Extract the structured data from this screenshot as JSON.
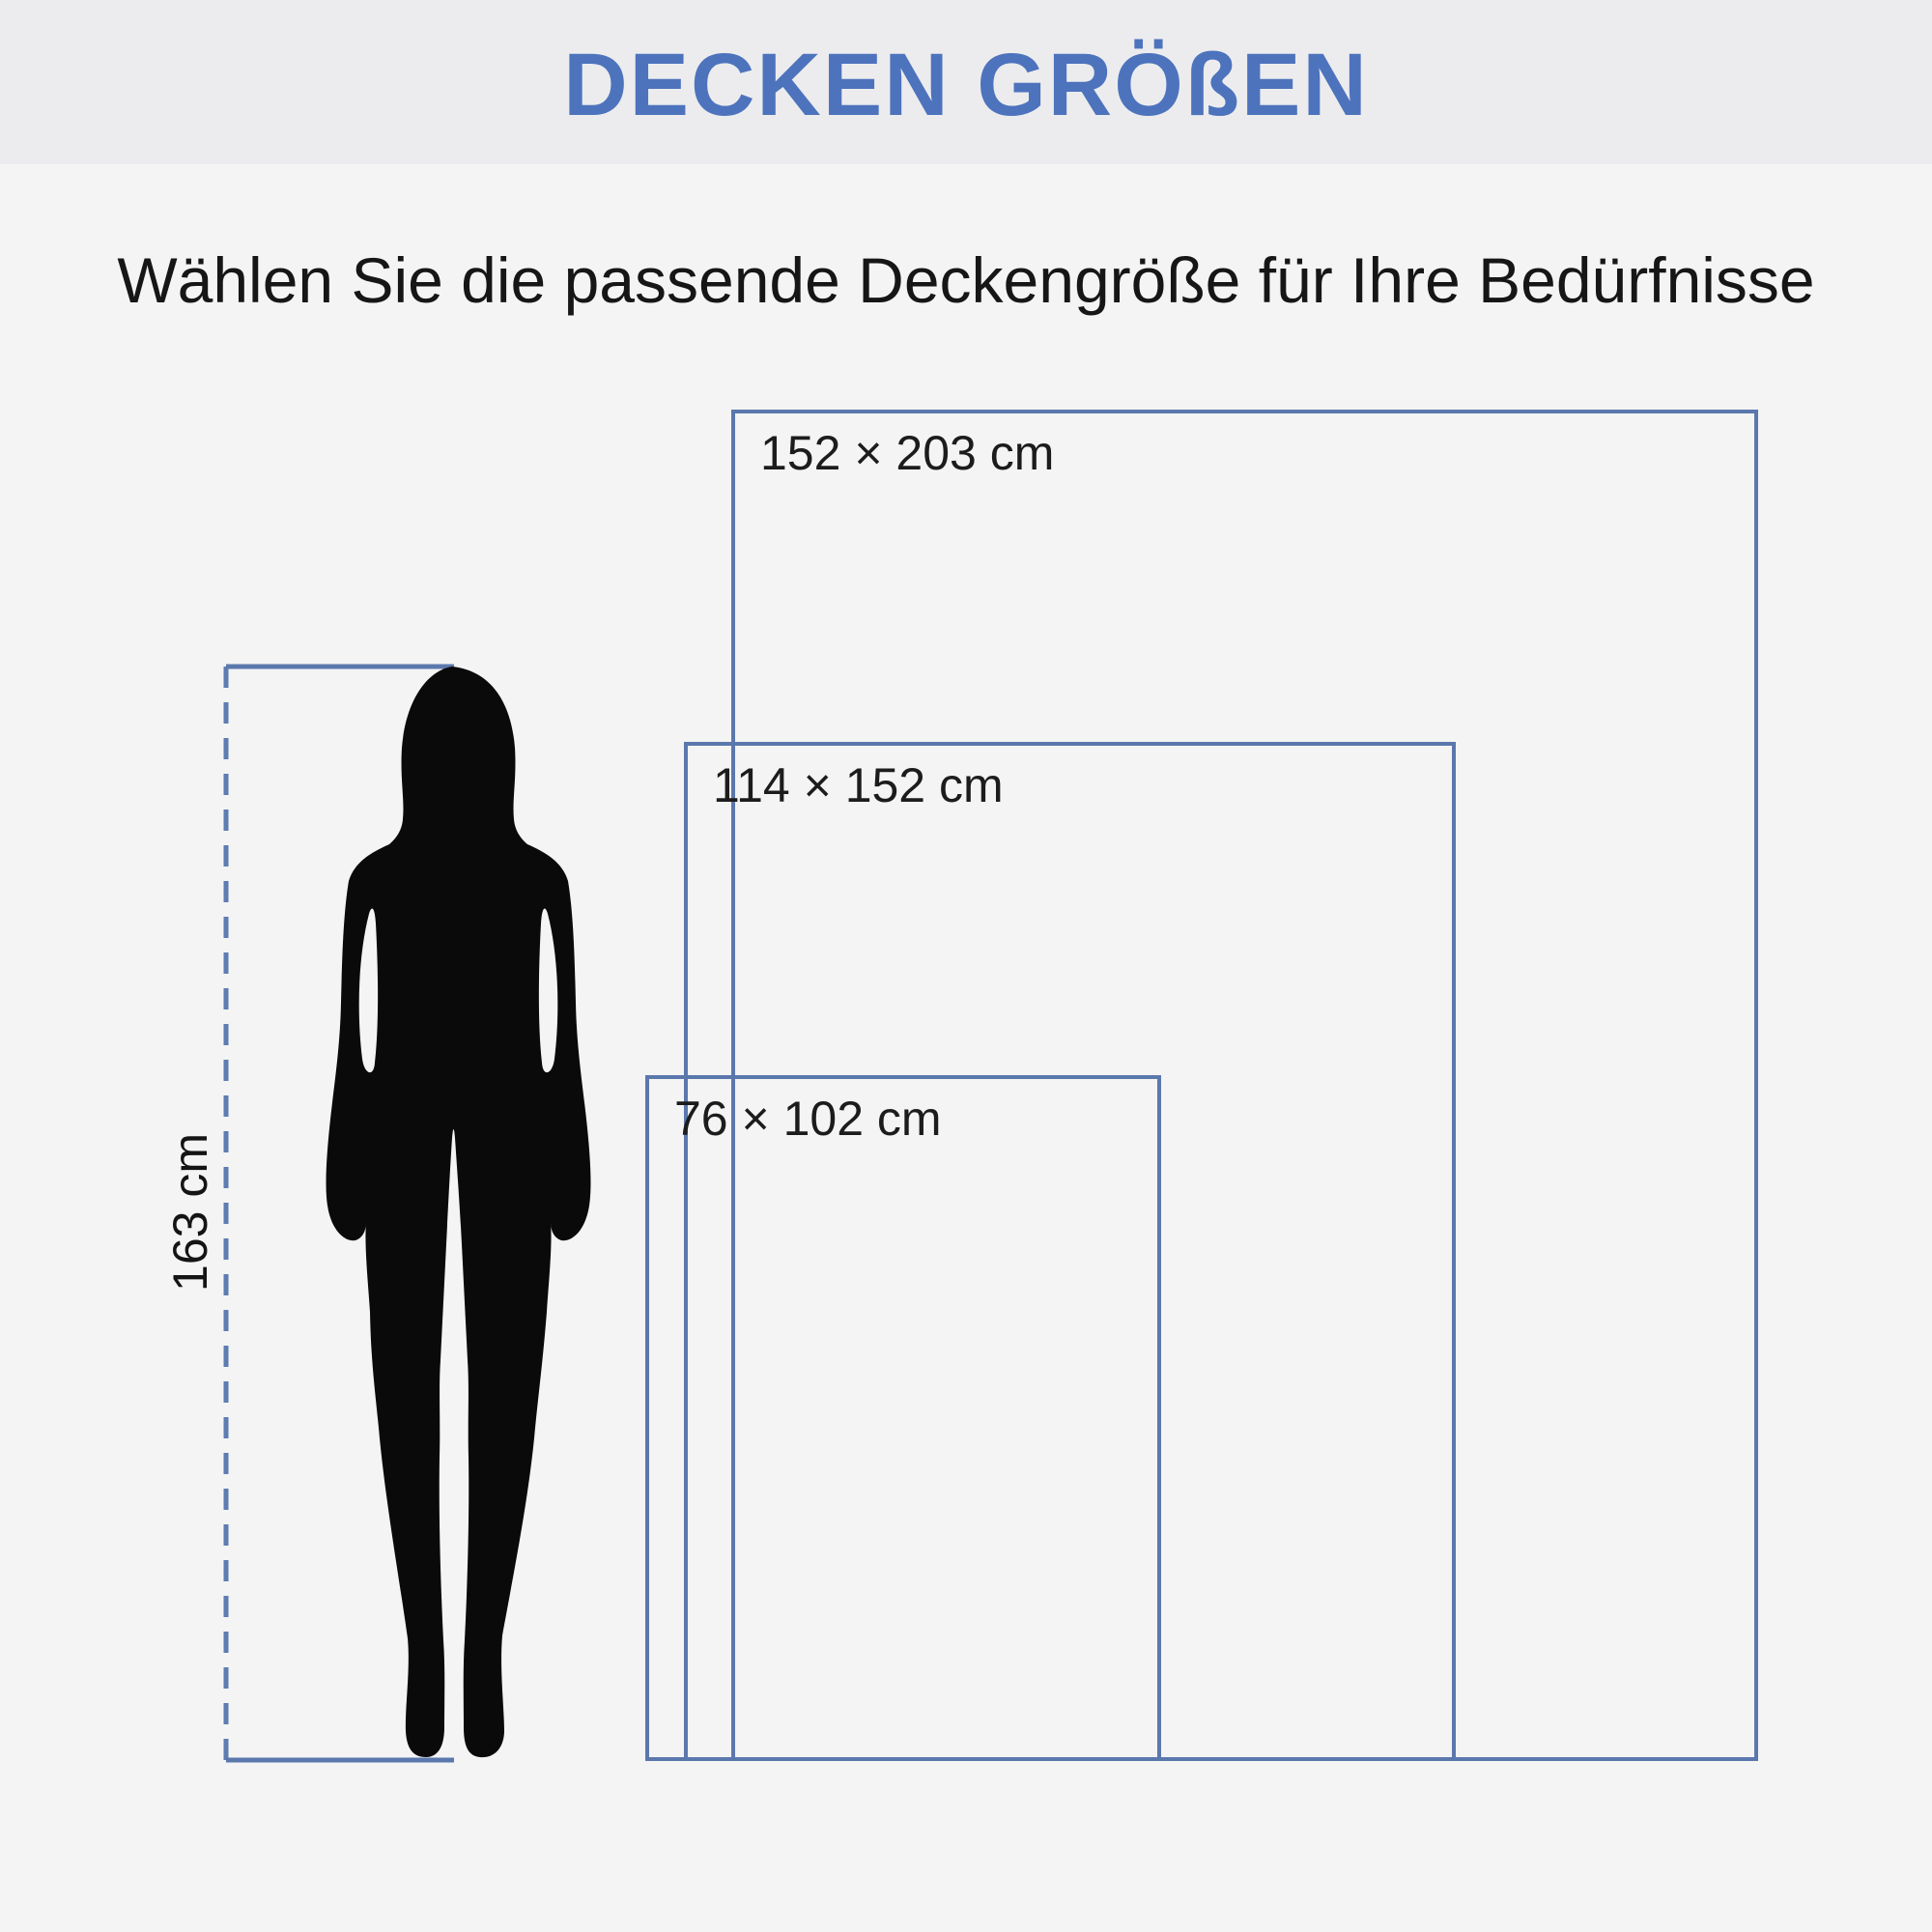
{
  "header": {
    "title": "DECKEN GRÖßEN"
  },
  "subtitle": "Wählen Sie die passende Deckengröße für Ihre Bedürfnisse",
  "blankets": [
    {
      "label": "152 × 203 cm",
      "width_cm": 152,
      "height_cm": 203
    },
    {
      "label": "114 × 152 cm",
      "width_cm": 114,
      "height_cm": 152
    },
    {
      "label": "76 × 102 cm",
      "width_cm": 76,
      "height_cm": 102
    }
  ],
  "person": {
    "height_label": "163 cm",
    "height_cm": 163
  },
  "colors": {
    "accent_title": "#4d73bd",
    "line_blue": "#5b78ad",
    "band_background": "#ececee",
    "page_background": "#f3f4f3",
    "text": "#161616",
    "silhouette": "#0a0a0a"
  }
}
